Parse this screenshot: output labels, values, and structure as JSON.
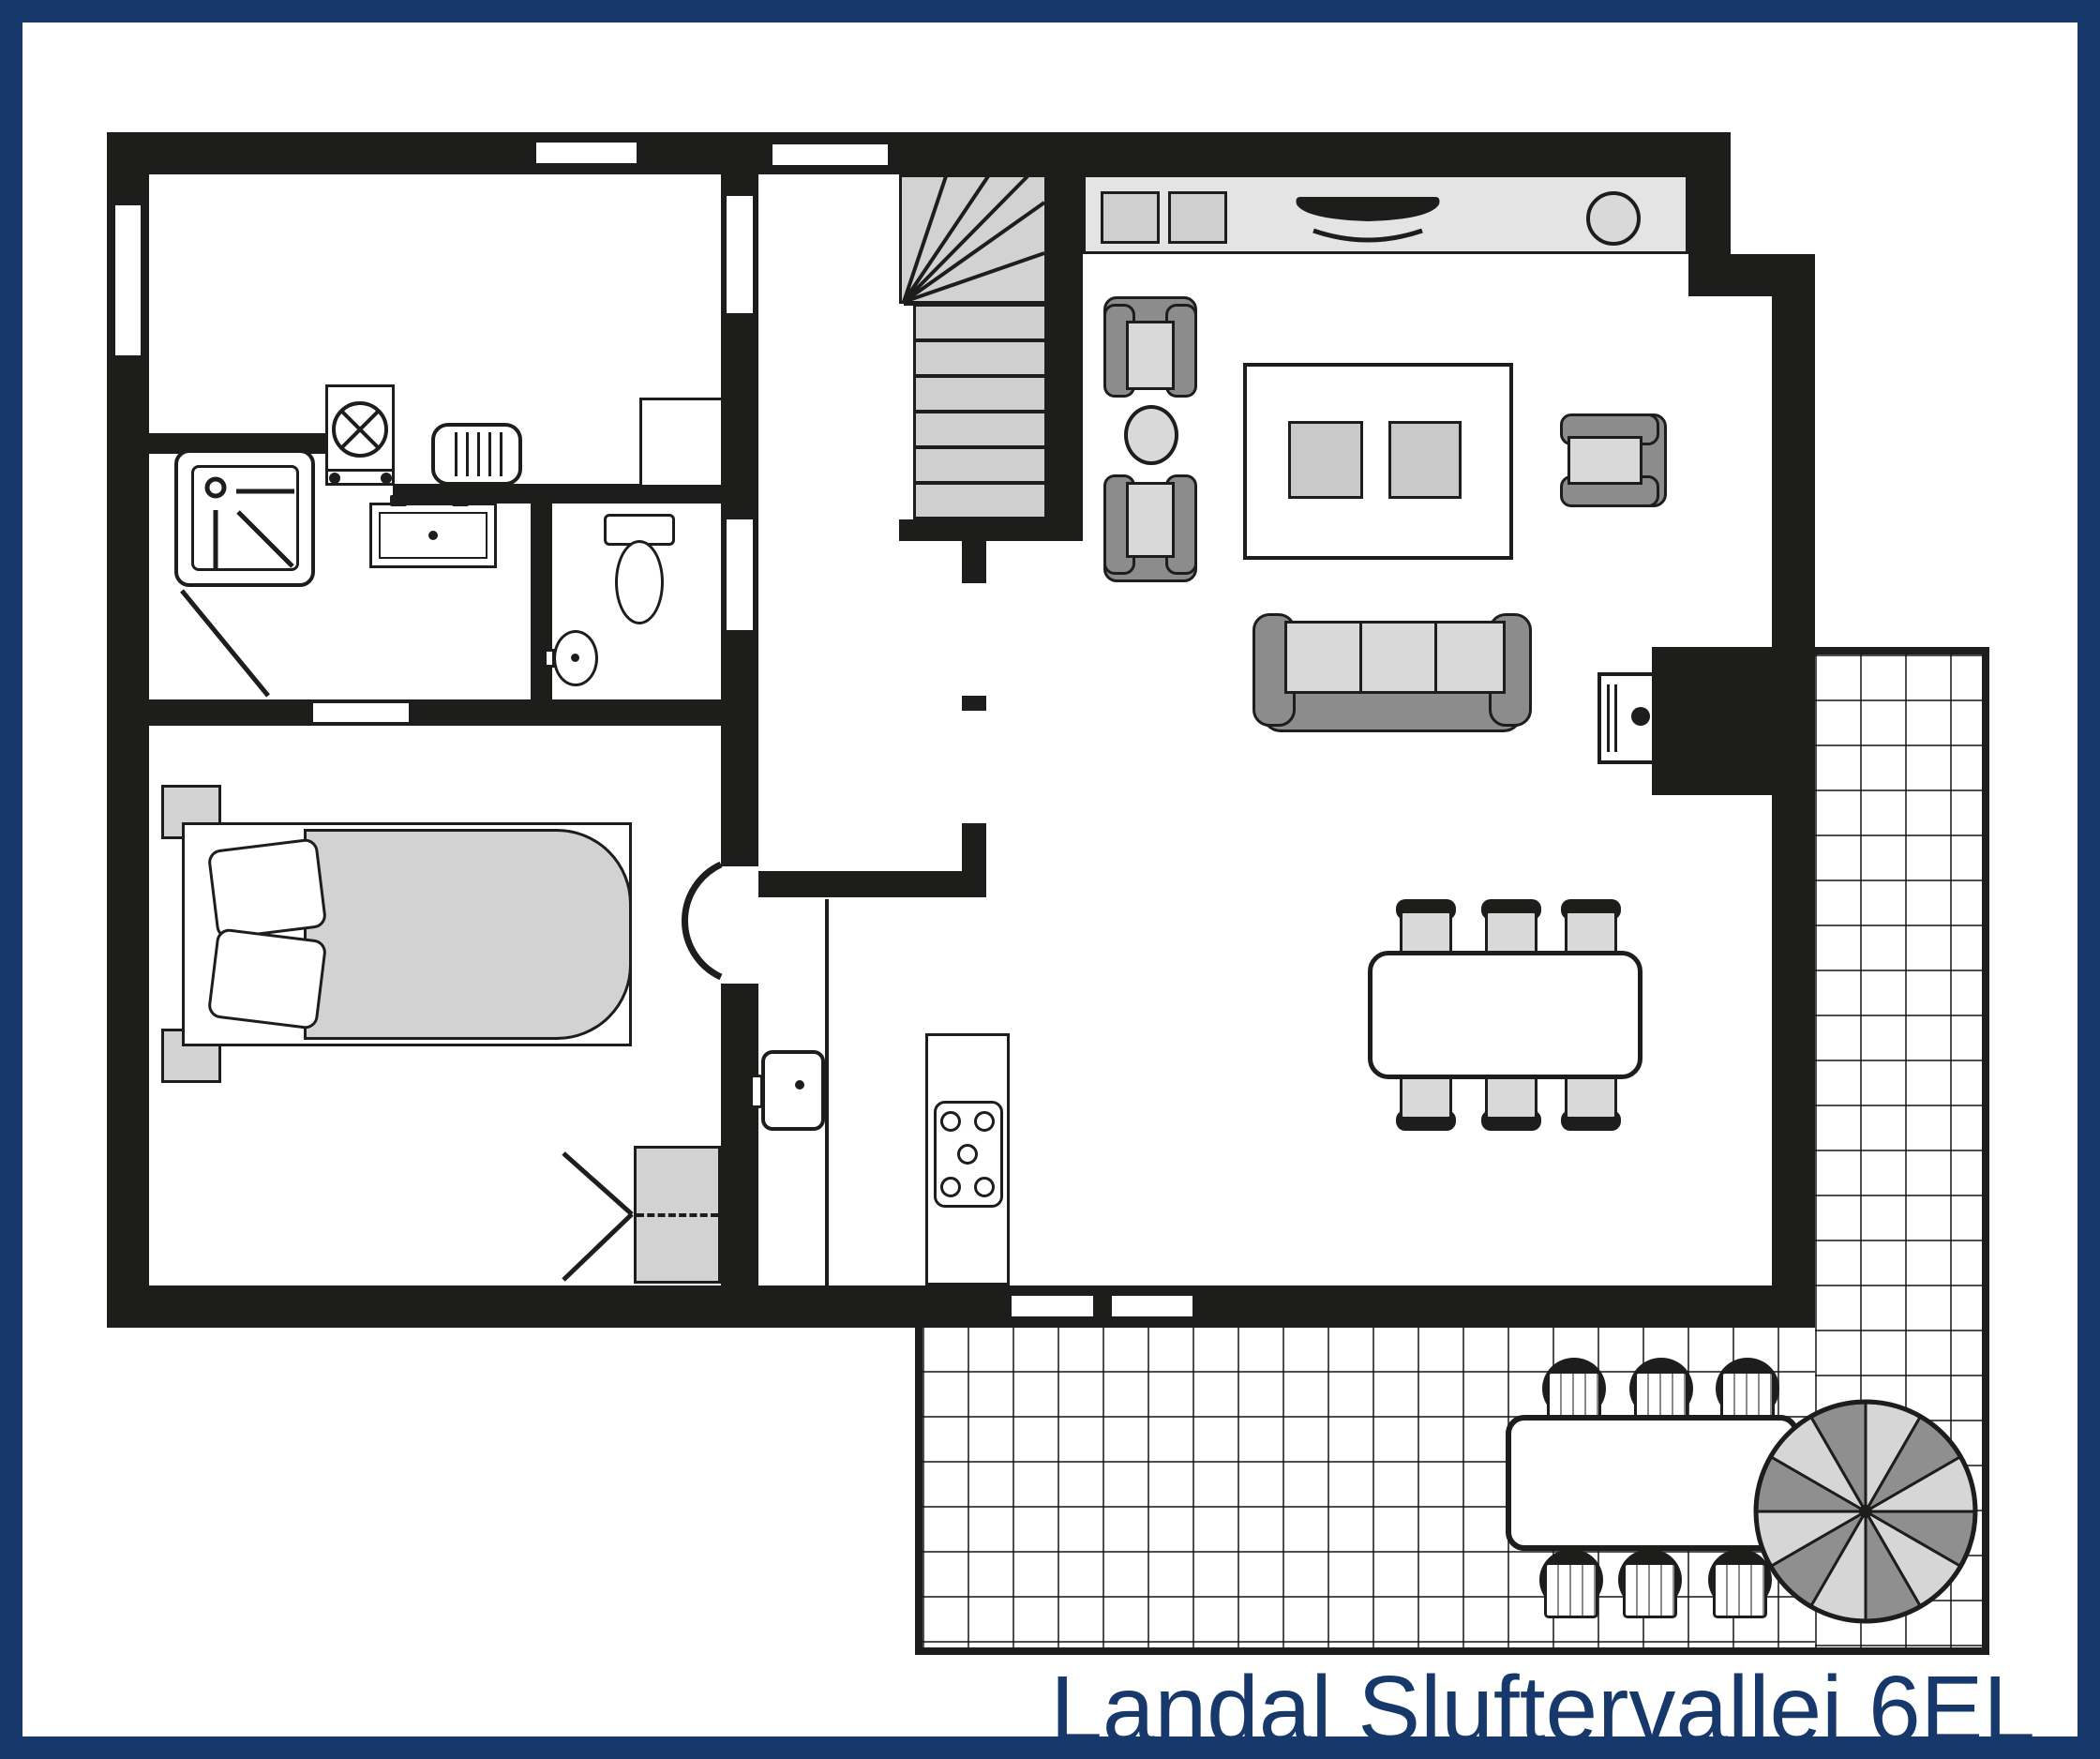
{
  "title": "Landal Sluftervallei 6EL",
  "colors": {
    "frame_navy": "#16386b",
    "wall_black": "#1d1d1b",
    "light_gray": "#d9d9d9",
    "counter_gray": "#e4e4e4",
    "mid_gray": "#8c8c8c",
    "title_navy": "#16386b"
  },
  "plan": {
    "floor": "ground floor",
    "rooms": [
      "utility-room",
      "bathroom",
      "toilet",
      "bedroom",
      "hall",
      "staircase",
      "living-room",
      "kitchen",
      "dining-area",
      "terrace"
    ],
    "furniture": [
      "washing-machine",
      "radiator",
      "cabinet",
      "shower",
      "washbasin-vanity",
      "toilet",
      "corner-basin",
      "double-bed",
      "nightstand",
      "wardrobe",
      "winder-staircase",
      "kitchen-counter",
      "hob-2-plate",
      "counter-sink",
      "round-basin",
      "armchair",
      "side-table",
      "rug-with-cushions",
      "sofa",
      "fireplace-stove",
      "dining-table",
      "dining-chair",
      "kitchen-island",
      "hob-5-burner",
      "worktop-sink",
      "terrace-table",
      "terrace-chair",
      "parasol"
    ]
  }
}
